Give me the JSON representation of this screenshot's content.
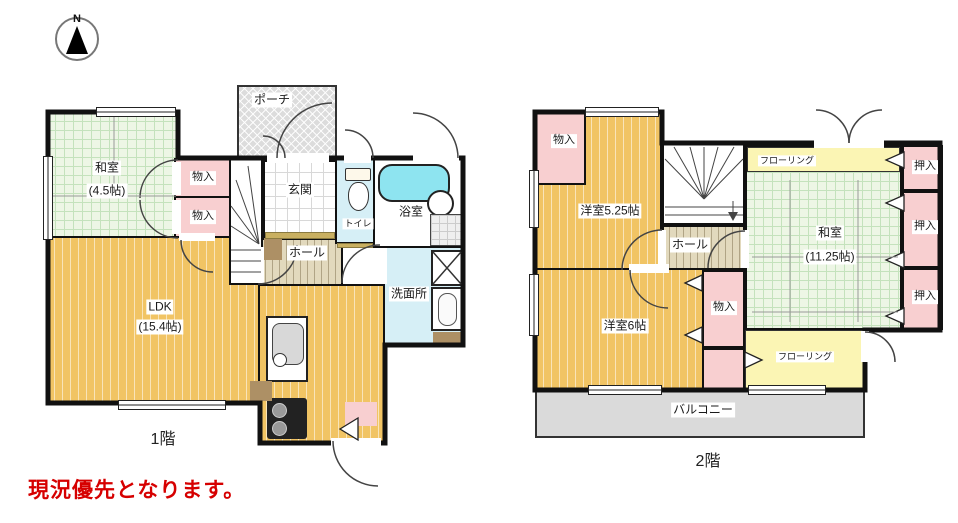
{
  "compass": {
    "north": "N"
  },
  "floor1": {
    "title": "1階",
    "rooms": {
      "washitsu": {
        "name": "和室",
        "size": "(4.5帖)"
      },
      "porch": {
        "name": "ポーチ"
      },
      "genkan": {
        "name": "玄関"
      },
      "storage_a": {
        "name": "物入"
      },
      "storage_b": {
        "name": "物入"
      },
      "toilet": {
        "name": "トイレ"
      },
      "bath": {
        "name": "浴室"
      },
      "hall": {
        "name": "ホール"
      },
      "washroom": {
        "name": "洗面所"
      },
      "ldk": {
        "name": "LDK",
        "size": "(15.4帖)"
      }
    }
  },
  "floor2": {
    "title": "2階",
    "rooms": {
      "storage_top": {
        "name": "物入"
      },
      "western_525": {
        "name": "洋室5.25帖"
      },
      "hall": {
        "name": "ホール"
      },
      "flooring_north": {
        "name": "フローリング"
      },
      "washitsu": {
        "name": "和室",
        "size": "(11.25帖)"
      },
      "closet_a": {
        "name": "押入"
      },
      "closet_b": {
        "name": "押入"
      },
      "closet_c": {
        "name": "押入"
      },
      "storage_mid": {
        "name": "物入"
      },
      "western_6": {
        "name": "洋室6帖"
      },
      "flooring_south": {
        "name": "フローリング"
      },
      "balcony": {
        "name": "バルコニー"
      }
    }
  },
  "note": {
    "text": "現況優先となります。"
  },
  "palette": {
    "tatami_green": "#edf6e5",
    "wood_orange": "#f1c464",
    "closet_pink": "#f8cfd0",
    "wet_area_blue": "#d6eff6",
    "flooring_yellow": "#fbf5b4",
    "bathtub_cyan": "#8ee4f0",
    "porch_gray": "#dcdcdc",
    "wall_black": "#111111",
    "note_red": "#d60000"
  }
}
